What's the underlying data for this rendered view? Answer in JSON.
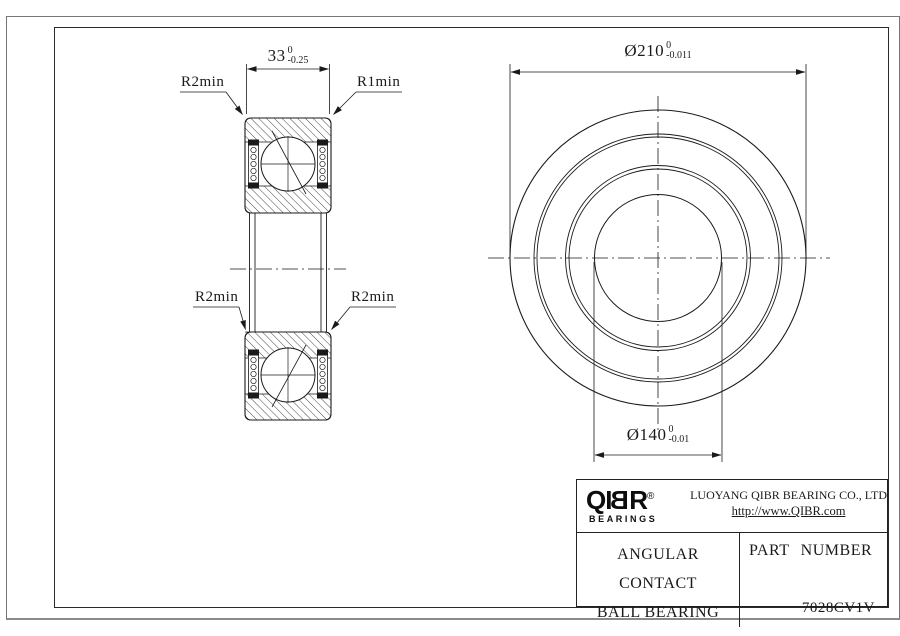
{
  "drawing": {
    "section_view": {
      "width_dim": {
        "value": "33",
        "tol_upper": "0",
        "tol_lower": "-0.25"
      },
      "labels": {
        "top_left": "R2min",
        "top_right": "R1min",
        "bottom_left": "R2min",
        "bottom_right": "R2min"
      }
    },
    "front_view": {
      "outer_dia_dim": {
        "value": "Ø210",
        "tol_upper": "0",
        "tol_lower": "-0.011"
      },
      "bore_dia_dim": {
        "value": "Ø140",
        "tol_upper": "0",
        "tol_lower": "-0.01"
      }
    }
  },
  "title_block": {
    "logo": {
      "part1": "QI",
      "mirrored_letter": "B",
      "part2": "R",
      "registered": "®",
      "subtext": "BEARINGS"
    },
    "company": "LUOYANG QIBR BEARING CO., LTD",
    "website": "http://www.QIBR.com",
    "product_line1": "ANGULAR CONTACT",
    "product_line2": "BALL BEARING",
    "part_number_label": "PART NUMBER",
    "part_number": "7028CV1V"
  },
  "colors": {
    "line": "#1a1a1a",
    "border_outer": "#777777",
    "border_inner": "#2a2a2a",
    "background": "#ffffff"
  }
}
